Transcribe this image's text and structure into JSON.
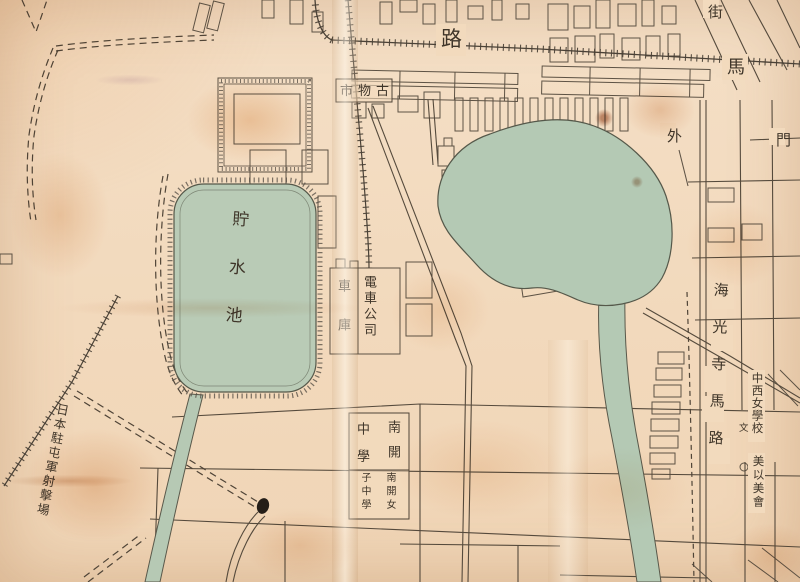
{
  "map_type": "historical-city-map",
  "colors": {
    "paper": "#f2dabd",
    "water": "#b6c9b4",
    "line": "#554a3c",
    "ink_blot": "#241e18"
  },
  "labels": {
    "road_char": {
      "text": "路"
    },
    "street_char": {
      "text": "街"
    },
    "ma_char": {
      "text": "馬"
    },
    "wai_char": {
      "text": "外"
    },
    "men_char": {
      "text": "門"
    },
    "haiguangsi_road": {
      "text": "海光寺馬路"
    },
    "zhongxi_girls_school": {
      "text": "中西女學校"
    },
    "wen_symbol": {
      "text": "文"
    },
    "meiyimei_church": {
      "text": "美以美會"
    },
    "reservoir": {
      "text": "貯水池"
    },
    "tram_company": {
      "text": "電車公司"
    },
    "tram_depot": {
      "text": "車庫"
    },
    "nankai_col_right": {
      "text": "南開"
    },
    "nankai_col_left": {
      "text": "中學"
    },
    "nankai_girls_col_right": {
      "text": "南開女"
    },
    "nankai_girls_col_left": {
      "text": "子中學"
    },
    "antique_market": {
      "text": "市物古"
    },
    "japanese_garrison_range": {
      "text": "日本駐屯軍射擊場"
    }
  }
}
